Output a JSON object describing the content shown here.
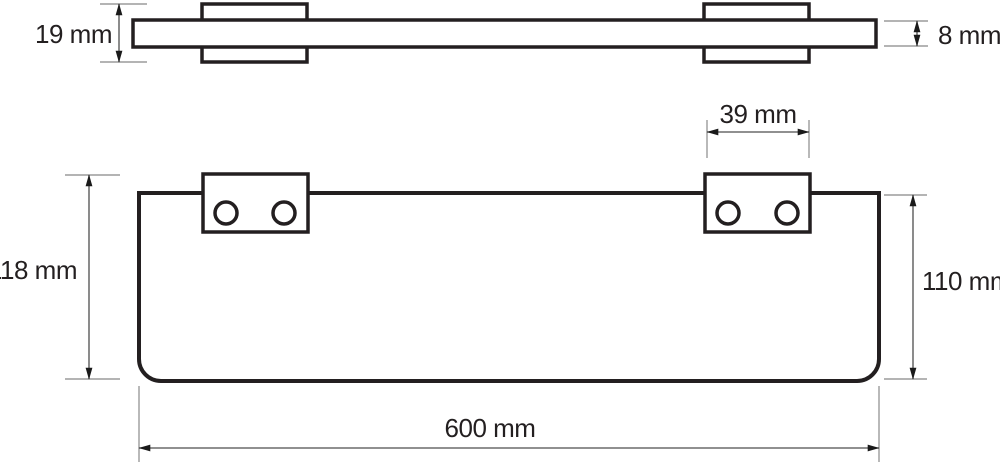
{
  "drawing": {
    "kind": "technical-dimension-drawing",
    "subject": "wall-mounted glass shelf with two brackets, top view and front view"
  },
  "colors": {
    "outline": "#231f20",
    "dimension_line": "#4d4d4d",
    "extension_line": "#9b9b9b",
    "text": "#231f20",
    "background": "#ffffff"
  },
  "top_view": {
    "dim_bracket_height": {
      "label": "19 mm"
    },
    "dim_glass_thickness": {
      "label": "8 mm"
    }
  },
  "front_view": {
    "dim_bracket_width": {
      "label": "39 mm"
    },
    "dim_total_height": {
      "label": "118 mm"
    },
    "dim_shelf_height": {
      "label": "110 mm"
    },
    "dim_shelf_width": {
      "label": "600 mm"
    }
  }
}
